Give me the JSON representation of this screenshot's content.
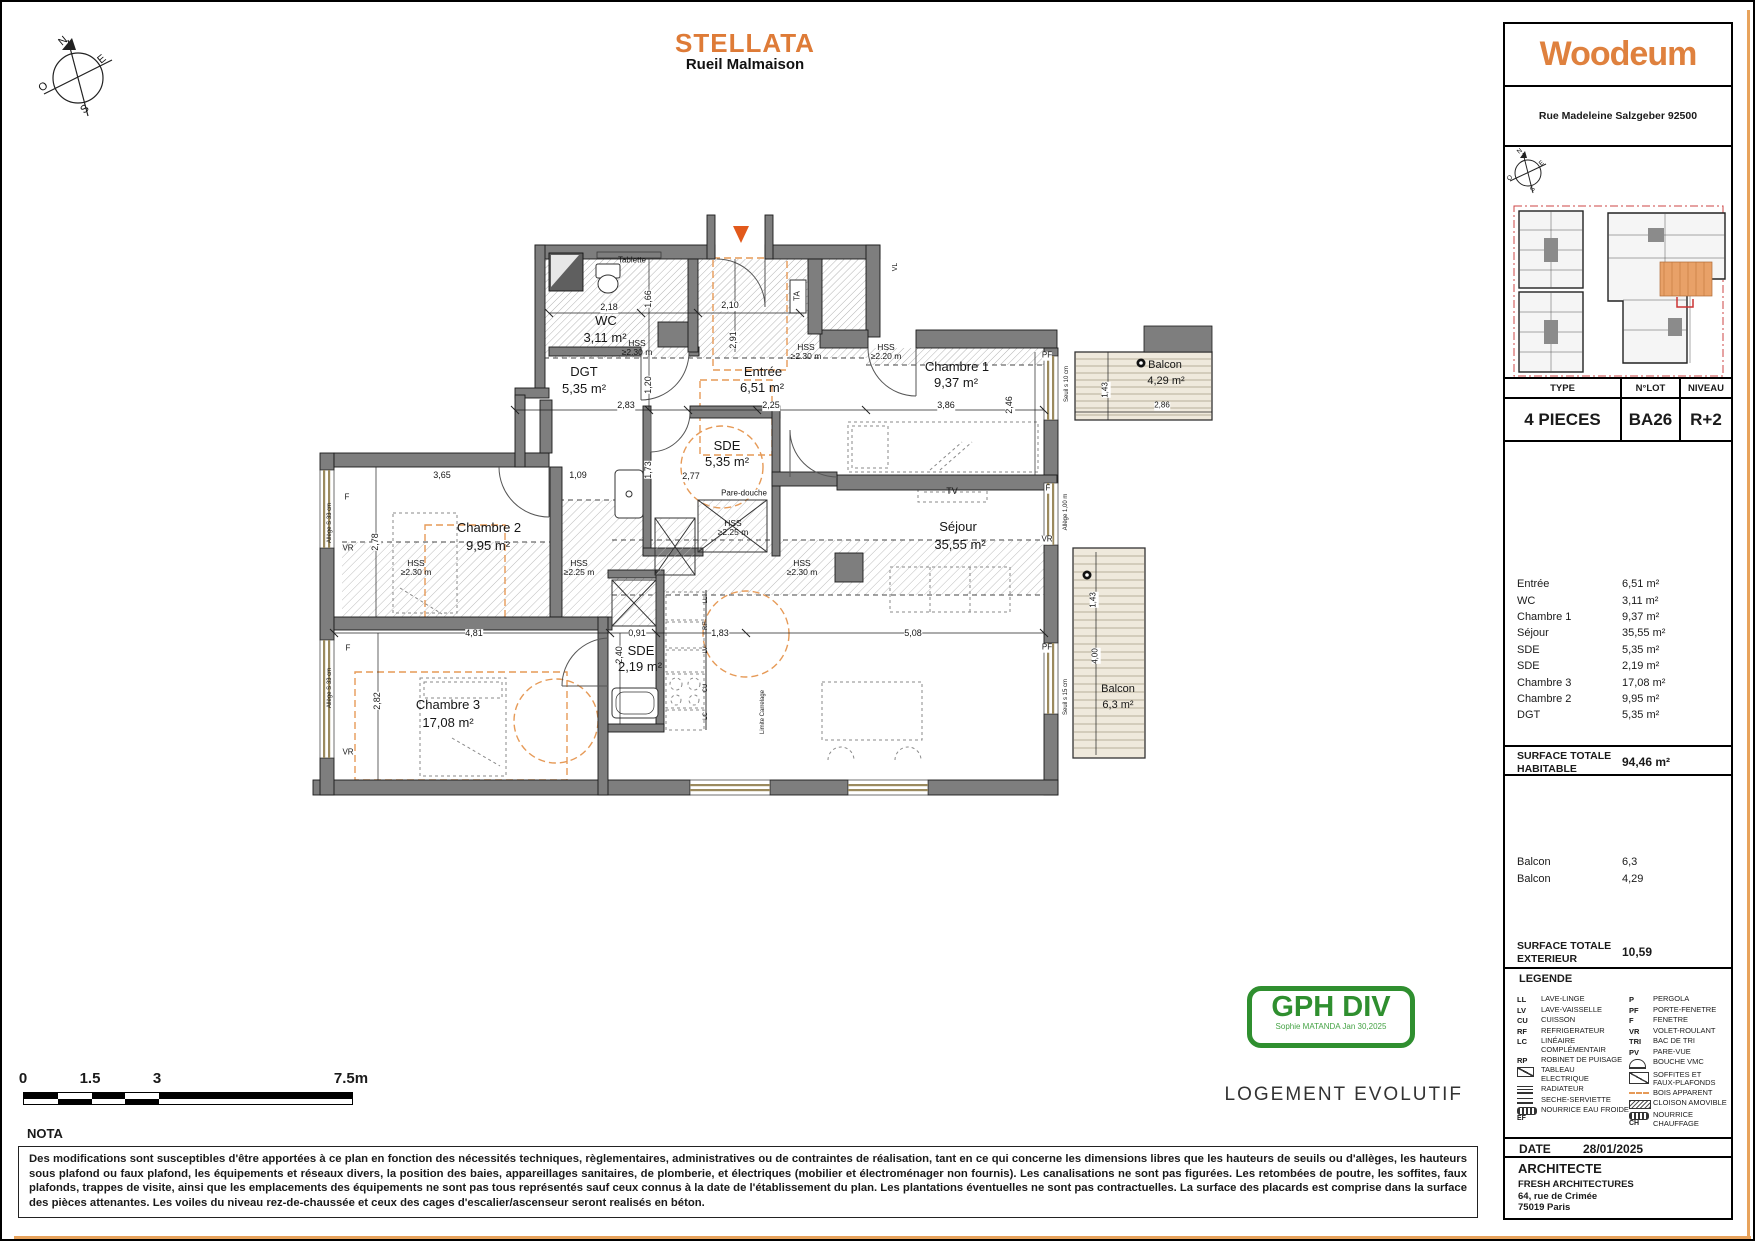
{
  "header": {
    "title": "STELLATA",
    "subtitle": "Rueil Malmaison"
  },
  "compass": {
    "n": "N",
    "e": "E",
    "s": "S",
    "o": "O"
  },
  "sidebar": {
    "brand": "Woodeum",
    "address": "Rue Madeleine Salzgeber 92500",
    "table": {
      "type_label": "TYPE",
      "lot_label": "N°LOT",
      "niveau_label": "NIVEAU",
      "type": "4 PIECES",
      "lot": "BA26",
      "niveau": "R+2"
    },
    "rooms": [
      {
        "name": "Entrée",
        "area": "6,51 m²"
      },
      {
        "name": "WC",
        "area": "3,11 m²"
      },
      {
        "name": "Chambre 1",
        "area": "9,37 m²"
      },
      {
        "name": "Séjour",
        "area": "35,55 m²"
      },
      {
        "name": "SDE",
        "area": "5,35 m²"
      },
      {
        "name": "SDE",
        "area": "2,19 m²"
      },
      {
        "name": "Chambre 3",
        "area": "17,08 m²"
      },
      {
        "name": "Chambre 2",
        "area": "9,95 m²"
      },
      {
        "name": "DGT",
        "area": "5,35 m²"
      }
    ],
    "surface_habitable": {
      "label": "SURFACE TOTALE\nHABITABLE",
      "value": "94,46 m²"
    },
    "exterior_rooms": [
      {
        "name": "Balcon",
        "area": "6,3"
      },
      {
        "name": "Balcon",
        "area": "4,29"
      }
    ],
    "surface_exterieur": {
      "label": "SURFACE TOTALE\nEXTERIEUR",
      "value": "10,59"
    },
    "legend": {
      "title": "LEGENDE",
      "left": [
        {
          "abbr": "LL",
          "label": "LAVE-LINGE"
        },
        {
          "abbr": "LV",
          "label": "LAVE-VAISSELLE"
        },
        {
          "abbr": "CU",
          "label": "CUISSON"
        },
        {
          "abbr": "RF",
          "label": "REFRIGERATEUR"
        },
        {
          "abbr": "LC",
          "label": "LINÉAIRE\nCOMPLÉMENTAIR"
        },
        {
          "abbr": "RP",
          "label": "ROBINET DE PUISAGE"
        },
        {
          "icon": "ta",
          "label": "TABLEAU\nELECTRIQUE"
        },
        {
          "icon": "rad",
          "label": "RADIATEUR"
        },
        {
          "icon": "towel",
          "label": "SECHE-SERVIETTE"
        },
        {
          "icon": "manifold",
          "sub": "EF",
          "label": "NOURRICE EAU FROIDE"
        }
      ],
      "right": [
        {
          "abbr": "P",
          "label": "PERGOLA"
        },
        {
          "abbr": "PF",
          "label": "PORTE-FENETRE"
        },
        {
          "abbr": "F",
          "label": "FENETRE"
        },
        {
          "abbr": "VR",
          "label": "VOLET-ROULANT"
        },
        {
          "abbr": "TRI",
          "label": "BAC DE TRI"
        },
        {
          "abbr": "PV",
          "label": "PARE-VUE"
        },
        {
          "icon": "vmc",
          "label": "BOUCHE VMC"
        },
        {
          "icon": "soffit",
          "label": "SOFFITES ET\nFAUX-PLAFONDS"
        },
        {
          "icon": "wood",
          "label": "BOIS APPARENT"
        },
        {
          "icon": "cloison",
          "label": "CLOISON AMOVIBLE"
        },
        {
          "icon": "manifold",
          "sub": "CH",
          "label": "NOURRICE CHAUFFAGE"
        }
      ]
    },
    "date": {
      "label": "DATE",
      "value": "28/01/2025"
    },
    "architect": {
      "label": "ARCHITECTE",
      "name": "FRESH ARCHITECTURES",
      "address1": "64, rue de Crimée",
      "address2": "75019 Paris"
    }
  },
  "plan": {
    "labels": [
      {
        "t": "Tablette",
        "x": 632,
        "y": 261,
        "s": 8
      },
      {
        "t": "WC",
        "x": 606,
        "y": 321,
        "s": 13
      },
      {
        "t": "3,11 m²",
        "x": 605,
        "y": 338,
        "s": 13
      },
      {
        "t": "HSS\n≥2.30 m",
        "x": 637,
        "y": 348,
        "s": 8.5
      },
      {
        "t": "2,18",
        "x": 609,
        "y": 308,
        "s": 9,
        "bg": 1
      },
      {
        "t": "1,66",
        "x": 649,
        "y": 299,
        "s": 9,
        "r": -90,
        "bg": 1
      },
      {
        "t": "2,10",
        "x": 730,
        "y": 306,
        "s": 9,
        "bg": 1
      },
      {
        "t": "2,91",
        "x": 734,
        "y": 340,
        "s": 9,
        "r": -90,
        "bg": 1
      },
      {
        "t": "VL",
        "x": 896,
        "y": 267,
        "s": 7,
        "r": -90
      },
      {
        "t": "DGT",
        "x": 584,
        "y": 372,
        "s": 13
      },
      {
        "t": "5,35 m²",
        "x": 584,
        "y": 389,
        "s": 13
      },
      {
        "t": "1,20",
        "x": 649,
        "y": 385,
        "s": 9,
        "r": -90,
        "bg": 1
      },
      {
        "t": "2,83",
        "x": 626,
        "y": 406,
        "s": 9,
        "bg": 1
      },
      {
        "t": "Entrée",
        "x": 763,
        "y": 372,
        "s": 13
      },
      {
        "t": "6,51 m²",
        "x": 762,
        "y": 388,
        "s": 13
      },
      {
        "t": "2,25",
        "x": 771,
        "y": 406,
        "s": 9,
        "bg": 1
      },
      {
        "t": "TA",
        "x": 798,
        "y": 296,
        "s": 8,
        "r": -90
      },
      {
        "t": "HSS\n≥2.30 m",
        "x": 806,
        "y": 352,
        "s": 8.5
      },
      {
        "t": "HSS\n≥2.20 m",
        "x": 886,
        "y": 352,
        "s": 8.5
      },
      {
        "t": "Chambre 1",
        "x": 957,
        "y": 367,
        "s": 13
      },
      {
        "t": "9,37 m²",
        "x": 956,
        "y": 383,
        "s": 13
      },
      {
        "t": "3,86",
        "x": 946,
        "y": 406,
        "s": 9,
        "bg": 1
      },
      {
        "t": "2,46",
        "x": 1010,
        "y": 405,
        "s": 9,
        "r": -90,
        "bg": 1
      },
      {
        "t": "PF",
        "x": 1047,
        "y": 356,
        "s": 8,
        "bg": 1
      },
      {
        "t": "Seuil s 10 cm",
        "x": 1067,
        "y": 384,
        "s": 6,
        "r": -90
      },
      {
        "t": "Balcon",
        "x": 1165,
        "y": 366,
        "s": 11
      },
      {
        "t": "4,29 m²",
        "x": 1166,
        "y": 382,
        "s": 11
      },
      {
        "t": "1,43",
        "x": 1106,
        "y": 390,
        "s": 8,
        "r": -90,
        "bg": 1
      },
      {
        "t": "2,86",
        "x": 1162,
        "y": 406,
        "s": 8,
        "bg": 1
      },
      {
        "t": "SDE",
        "x": 727,
        "y": 446,
        "s": 13
      },
      {
        "t": "5,35 m²",
        "x": 727,
        "y": 462,
        "s": 13
      },
      {
        "t": "1,73",
        "x": 649,
        "y": 470,
        "s": 9,
        "r": -90,
        "bg": 1
      },
      {
        "t": "2,77",
        "x": 691,
        "y": 477,
        "s": 9,
        "bg": 1
      },
      {
        "t": "Pare-douche",
        "x": 744,
        "y": 494,
        "s": 8,
        "bg": 1
      },
      {
        "t": "HSS\n≥2.25 m",
        "x": 733,
        "y": 528,
        "s": 8.5
      },
      {
        "t": "3,65",
        "x": 442,
        "y": 476,
        "s": 9,
        "bg": 1
      },
      {
        "t": "1,09",
        "x": 578,
        "y": 476,
        "s": 9,
        "bg": 1
      },
      {
        "t": "Chambre 2",
        "x": 489,
        "y": 528,
        "s": 13
      },
      {
        "t": "9,95 m²",
        "x": 488,
        "y": 546,
        "s": 13
      },
      {
        "t": "2,78",
        "x": 376,
        "y": 542,
        "s": 9,
        "r": -90,
        "bg": 1
      },
      {
        "t": "F",
        "x": 347,
        "y": 498,
        "s": 8
      },
      {
        "t": "VR",
        "x": 348,
        "y": 549,
        "s": 8
      },
      {
        "t": "Allège S 33 cm",
        "x": 330,
        "y": 523,
        "s": 6,
        "r": -90
      },
      {
        "t": "HSS\n≥2.30 m",
        "x": 416,
        "y": 568,
        "s": 8.5
      },
      {
        "t": "HSS\n≥2.25 m",
        "x": 579,
        "y": 568,
        "s": 8.5
      },
      {
        "t": "Séjour",
        "x": 958,
        "y": 527,
        "s": 13
      },
      {
        "t": "35,55 m²",
        "x": 960,
        "y": 545,
        "s": 13
      },
      {
        "t": "TV",
        "x": 952,
        "y": 492,
        "s": 9
      },
      {
        "t": "HSS\n≥2.30 m",
        "x": 802,
        "y": 568,
        "s": 8.5
      },
      {
        "t": "F",
        "x": 1048,
        "y": 489,
        "s": 8,
        "bg": 1
      },
      {
        "t": "Allège 1,00 m",
        "x": 1066,
        "y": 512,
        "s": 6,
        "r": -90
      },
      {
        "t": "VR",
        "x": 1047,
        "y": 540,
        "s": 8,
        "bg": 1
      },
      {
        "t": "4,81",
        "x": 474,
        "y": 634,
        "s": 9,
        "bg": 1
      },
      {
        "t": "0,91",
        "x": 637,
        "y": 634,
        "s": 9,
        "bg": 1
      },
      {
        "t": "1,83",
        "x": 720,
        "y": 634,
        "s": 9,
        "bg": 1
      },
      {
        "t": "5,08",
        "x": 913,
        "y": 634,
        "s": 9,
        "bg": 1
      },
      {
        "t": "2,40",
        "x": 620,
        "y": 655,
        "s": 9,
        "r": -90,
        "bg": 1
      },
      {
        "t": "SDE",
        "x": 641,
        "y": 651,
        "s": 13
      },
      {
        "t": "2,19 m²",
        "x": 640,
        "y": 667,
        "s": 13
      },
      {
        "t": "Chambre 3",
        "x": 448,
        "y": 705,
        "s": 13
      },
      {
        "t": "17,08 m²",
        "x": 448,
        "y": 723,
        "s": 13
      },
      {
        "t": "2,82",
        "x": 378,
        "y": 701,
        "s": 9,
        "r": -90,
        "bg": 1
      },
      {
        "t": "F",
        "x": 348,
        "y": 649,
        "s": 8
      },
      {
        "t": "VR",
        "x": 348,
        "y": 753,
        "s": 8
      },
      {
        "t": "Allège S 33 cm",
        "x": 330,
        "y": 688,
        "s": 6,
        "r": -90
      },
      {
        "t": "LL",
        "x": 706,
        "y": 600,
        "s": 6,
        "r": -90
      },
      {
        "t": "RF",
        "x": 706,
        "y": 626,
        "s": 6,
        "r": -90
      },
      {
        "t": "LV",
        "x": 706,
        "y": 650,
        "s": 6,
        "r": -90
      },
      {
        "t": "CU",
        "x": 706,
        "y": 688,
        "s": 6,
        "r": -90
      },
      {
        "t": "LC",
        "x": 706,
        "y": 716,
        "s": 6,
        "r": -90
      },
      {
        "t": "Limite Carrelage",
        "x": 763,
        "y": 712,
        "s": 6,
        "r": -90
      },
      {
        "t": "PF",
        "x": 1047,
        "y": 648,
        "s": 8,
        "bg": 1
      },
      {
        "t": "Seuil s 15 cm",
        "x": 1066,
        "y": 697,
        "s": 6,
        "r": -90
      },
      {
        "t": "1,43",
        "x": 1094,
        "y": 600,
        "s": 8,
        "r": -90,
        "bg": 1
      },
      {
        "t": "4,00",
        "x": 1096,
        "y": 656,
        "s": 8,
        "r": -90,
        "bg": 1
      },
      {
        "t": "Balcon",
        "x": 1118,
        "y": 690,
        "s": 11
      },
      {
        "t": "6,3 m²",
        "x": 1118,
        "y": 706,
        "s": 11
      }
    ]
  },
  "scalebar": {
    "labels": [
      {
        "text": "0",
        "x": 23
      },
      {
        "text": "1.5",
        "x": 90
      },
      {
        "text": "3",
        "x": 157
      },
      {
        "text": "7.5m",
        "x": 351
      }
    ]
  },
  "nota": {
    "title": "NOTA",
    "text": "Des modifications sont susceptibles d'être apportées à ce plan en fonction des nécessités techniques, règlementaires, administratives ou de contraintes de réalisation, tant en ce qui concerne les dimensions libres que les hauteurs de seuils ou d'allèges, les hauteurs sous plafond ou faux plafond, les équipements et réseaux divers, la position des baies, appareillages sanitaires, de plomberie, et électriques (mobilier et électroménager non fournis). Les canalisations ne sont pas figurées. Les retombées de poutre, les soffites, faux plafonds, trappes de visite, ainsi que les emplacements des équipements ne sont pas tous représentés sauf ceux connus à la date de l'établissement du plan. Les plantations éventuelles ne sont pas contractuelles. La surface des placards est comprise dans la surface des pièces attenantes. Les voiles du niveau rez-de-chaussée et ceux des cages d'escalier/ascenseur seront realisés en béton."
  },
  "stamp": {
    "line1": "GPH DIV",
    "line2": "Sophie MATANDA Jan 30,2025"
  },
  "footer_note": "LOGEMENT EVOLUTIF"
}
